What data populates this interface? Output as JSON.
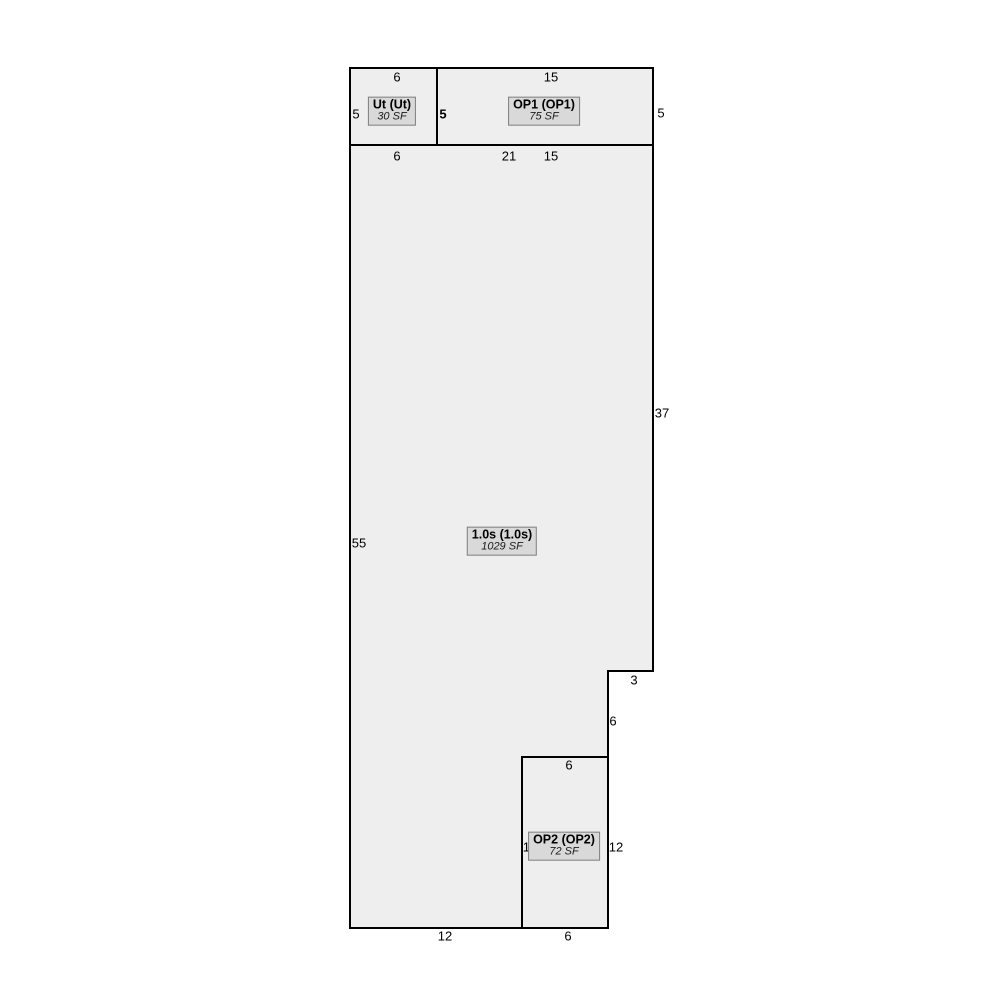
{
  "sketch": {
    "colors": {
      "area_fill": "#eeeeee",
      "label_fill": "#d9d9d9",
      "label_border": "#7f7f7f",
      "line": "#000000"
    },
    "areas": {
      "ut": {
        "label": "Ut (Ut)",
        "area": "30 SF"
      },
      "op1": {
        "label": "OP1 (OP1)",
        "area": "75 SF"
      },
      "main": {
        "label": "1.0s (1.0s)",
        "area": "1029 SF"
      },
      "op2": {
        "label": "OP2 (OP2)",
        "area": "72 SF"
      }
    },
    "dimensions": {
      "ut_top": "6",
      "ut_left": "5",
      "ut_op1_shared": "5",
      "ut_bottom": "6",
      "op1_top": "15",
      "op1_right": "5",
      "op1_bottom": "15",
      "main_top": "21",
      "main_left": "55",
      "main_right": "37",
      "main_bottom": "12",
      "step_top": "3",
      "step_right": "6",
      "op2_top": "6",
      "op2_left": "12",
      "op2_right": "12",
      "op2_bottom": "6"
    }
  }
}
